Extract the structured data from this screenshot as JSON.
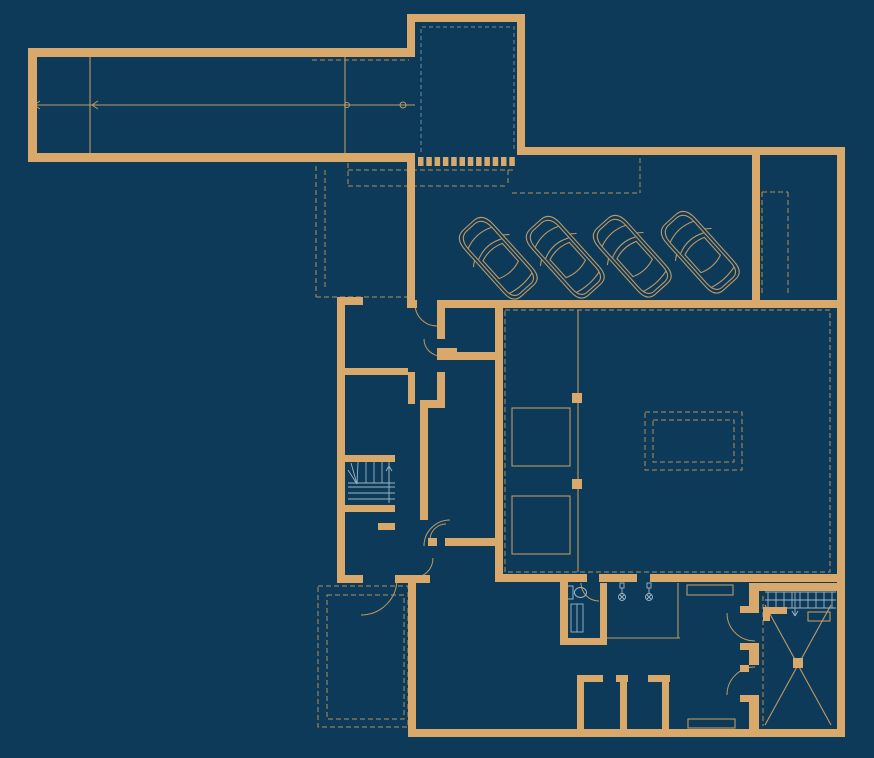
{
  "meta": {
    "description": "Architectural basement floor plan, dark navy background with tan walls, four parked cars in garage, winder staircase, bathroom fixtures and car-lift room"
  },
  "colors": {
    "background": "#0d3a59",
    "wall": "#d9a96b",
    "thin": "#bf9a62",
    "dash": "#b3905c",
    "teal_dash": "#5e7d92",
    "fixture": "#9db6c4",
    "car": "#bd9864"
  },
  "plan": {
    "viewbox": "0 0 874 758",
    "walls": [
      [
        28,
        48,
        9,
        114
      ],
      [
        36,
        48,
        375,
        9
      ],
      [
        28,
        153,
        387,
        9
      ],
      [
        407,
        14,
        8,
        43
      ],
      [
        407,
        14,
        118,
        8
      ],
      [
        517,
        14,
        8,
        141
      ],
      [
        517,
        147,
        328,
        8
      ],
      [
        837,
        147,
        8,
        590
      ],
      [
        752,
        155,
        8,
        148
      ],
      [
        407,
        162,
        8,
        146
      ],
      [
        341,
        297,
        22,
        8
      ],
      [
        407,
        300,
        10,
        8
      ],
      [
        437,
        300,
        408,
        8
      ],
      [
        337,
        297,
        8,
        286
      ],
      [
        495,
        300,
        8,
        282
      ],
      [
        437,
        303,
        8,
        36
      ],
      [
        437,
        348,
        20,
        5
      ],
      [
        437,
        352,
        60,
        8
      ],
      [
        437,
        372,
        8,
        31
      ],
      [
        420,
        400,
        25,
        8
      ],
      [
        420,
        408,
        8,
        112
      ],
      [
        341,
        368,
        67,
        7
      ],
      [
        408,
        372,
        7,
        32
      ],
      [
        445,
        538,
        52,
        8
      ],
      [
        428,
        538,
        9,
        8
      ],
      [
        345,
        455,
        50,
        7
      ],
      [
        345,
        505,
        50,
        7
      ],
      [
        378,
        523,
        17,
        7
      ],
      [
        337,
        575,
        26,
        8
      ],
      [
        395,
        575,
        35,
        8
      ],
      [
        408,
        580,
        8,
        157
      ],
      [
        408,
        729,
        437,
        8
      ],
      [
        560,
        575,
        8,
        70
      ],
      [
        495,
        574,
        92,
        8
      ],
      [
        599,
        574,
        38,
        8
      ],
      [
        650,
        574,
        195,
        8
      ],
      [
        600,
        583,
        7,
        61
      ],
      [
        560,
        638,
        47,
        7
      ],
      [
        577,
        675,
        7,
        55
      ],
      [
        577,
        675,
        26,
        7
      ],
      [
        616,
        675,
        12,
        7
      ],
      [
        620,
        675,
        7,
        55
      ],
      [
        648,
        675,
        22,
        7
      ],
      [
        662,
        675,
        7,
        55
      ],
      [
        749,
        583,
        10,
        30
      ],
      [
        749,
        643,
        10,
        22
      ],
      [
        749,
        695,
        10,
        42
      ],
      [
        749,
        583,
        96,
        8
      ],
      [
        740,
        606,
        9,
        7
      ],
      [
        740,
        643,
        9,
        7
      ],
      [
        740,
        665,
        9,
        7
      ],
      [
        740,
        695,
        9,
        7
      ],
      [
        763,
        607,
        24,
        7
      ],
      [
        763,
        607,
        7,
        14
      ],
      [
        572,
        393,
        10,
        10
      ],
      [
        572,
        479,
        10,
        10
      ],
      [
        793,
        658,
        10,
        10
      ]
    ],
    "grille": {
      "x0": 418,
      "y": 157,
      "n": 12,
      "w": 5.5,
      "h": 9,
      "step": 8.3
    },
    "thin_rects": [
      [
        512,
        408,
        58,
        58
      ],
      [
        512,
        496,
        58,
        58
      ],
      [
        687,
        585,
        46,
        10
      ],
      [
        688,
        719,
        47,
        9
      ],
      [
        808,
        612,
        22,
        9
      ]
    ],
    "thin_lines": [
      [
        90,
        57,
        90,
        153
      ],
      [
        345,
        57,
        345,
        153
      ],
      [
        32,
        105,
        415,
        105
      ],
      [
        578,
        310,
        578,
        572
      ],
      [
        607,
        638,
        680,
        638
      ],
      [
        678,
        583,
        678,
        638
      ],
      [
        765,
        605,
        831,
        725
      ],
      [
        831,
        605,
        765,
        725
      ]
    ],
    "dashed_lines": [
      [
        312,
        60,
        409,
        60
      ],
      [
        348,
        163,
        348,
        186
      ],
      [
        348,
        170,
        514,
        170
      ],
      [
        348,
        186,
        508,
        186
      ],
      [
        508,
        170,
        508,
        186
      ],
      [
        512,
        193,
        640,
        193
      ],
      [
        640,
        150,
        640,
        193
      ],
      [
        762,
        192,
        788,
        192
      ],
      [
        762,
        192,
        762,
        296
      ],
      [
        788,
        192,
        788,
        296
      ],
      [
        316,
        166,
        316,
        297
      ],
      [
        325,
        170,
        325,
        290
      ],
      [
        316,
        297,
        407,
        297
      ],
      [
        763,
        596,
        763,
        726
      ]
    ],
    "dashed_rects": [
      [
        505,
        310,
        325,
        262
      ],
      [
        645,
        412,
        97,
        58
      ],
      [
        653,
        420,
        81,
        42
      ],
      [
        318,
        586,
        90,
        141
      ],
      [
        327,
        595,
        77,
        124
      ]
    ],
    "teal_polyline": [
      [
        421,
        152
      ],
      [
        421,
        27
      ],
      [
        514,
        27
      ],
      [
        514,
        152
      ]
    ],
    "arcs": [
      "M 441 356 A 17 17 0 0 1 424 339",
      "M 424 546 A 26 26 0 0 1 450 520",
      "M 430 540 A 16 16 0 0 1 446 524",
      "M 413 578 A 20 20 0 0 0 433 558",
      "M 415 304 A 22 22 0 0 0 437 326",
      "M 397 579 A 36 36 0 0 1 361 615",
      "M 599 601 A 18 18 0 0 1 581 583",
      "M 755 641 A 28 28 0 0 1 727 613",
      "M 727 695 A 28 28 0 0 1 755 667"
    ],
    "circles": [
      {
        "cx": 347,
        "cy": 105,
        "r": 2.5
      },
      {
        "cx": 403,
        "cy": 105,
        "r": 3
      }
    ],
    "chevrons": [
      {
        "x": 34,
        "y": 105
      },
      {
        "x": 92,
        "y": 105
      }
    ],
    "stairs_winder": {
      "lines": [
        [
          348,
          483,
          395,
          483
        ],
        [
          366,
          462,
          366,
          483
        ],
        [
          374,
          462,
          374,
          483
        ],
        [
          382,
          462,
          382,
          483
        ],
        [
          389,
          462,
          389,
          483
        ],
        [
          357,
          484,
          348,
          470
        ],
        [
          357,
          484,
          351,
          463
        ],
        [
          357,
          484,
          358,
          462
        ],
        [
          348,
          487,
          395,
          487
        ],
        [
          348,
          493,
          395,
          493
        ],
        [
          348,
          499,
          395,
          499
        ],
        [
          389,
          503,
          389,
          466
        ],
        [
          389,
          466,
          386,
          471
        ],
        [
          389,
          466,
          392,
          471
        ]
      ]
    },
    "stairs_grid": {
      "x0": 768,
      "x1": 832,
      "step": 8,
      "y0": 592,
      "y1": 608,
      "rows": [
        592,
        600,
        608
      ],
      "row_x0": 765,
      "row_x1": 836,
      "arrow": [
        [
          795,
          592,
          795,
          616
        ],
        [
          795,
          616,
          792,
          611
        ],
        [
          795,
          616,
          798,
          611
        ]
      ]
    },
    "fixtures": {
      "toilet": {
        "tank": [
          566,
          586,
          7,
          13
        ],
        "bowl": {
          "cx": 580.5,
          "cy": 592.5,
          "rx": 6,
          "ry": 5
        }
      },
      "cabinet": {
        "rect": [
          571,
          604,
          12,
          28
        ],
        "line": [
          577,
          604,
          577,
          632
        ]
      },
      "shower_heads": {
        "y_plate": 583,
        "positions": [
          622,
          649
        ]
      }
    },
    "cars": {
      "positions": [
        {
          "cx": 498,
          "cy": 258,
          "angle": -42
        },
        {
          "cx": 565,
          "cy": 257,
          "angle": -42
        },
        {
          "cx": 632,
          "cy": 256,
          "angle": -42
        },
        {
          "cx": 700,
          "cy": 252,
          "angle": -42
        }
      ],
      "paths": [
        "M -19 -28 Q -19 -44 -7 -44 L 7 -44 Q 19 -44 19 -28 L 19 30 Q 19 44 8 44 L -8 44 Q -19 44 -19 30 Z",
        "M -16 -26 Q -16 -40 -6 -41 L 6 -41 Q 16 -40 16 -26 L 16 28 Q 16 41 7 41 L -7 41 Q -16 41 -16 28 Z",
        "M -15 -12 Q 0 -19 15 -12",
        "M -16 -27 Q 0 -34 16 -27",
        "M -13 -8 Q 0 -13 13 -8",
        "M -13 -8 L -13 16",
        "M 13 -8 L 13 16",
        "M -13 16 Q 0 21 13 16",
        "M -15 34 Q 0 38 15 34",
        "M -19 -14 L -24 -10",
        "M 19 -14 L 24 -10"
      ]
    }
  }
}
